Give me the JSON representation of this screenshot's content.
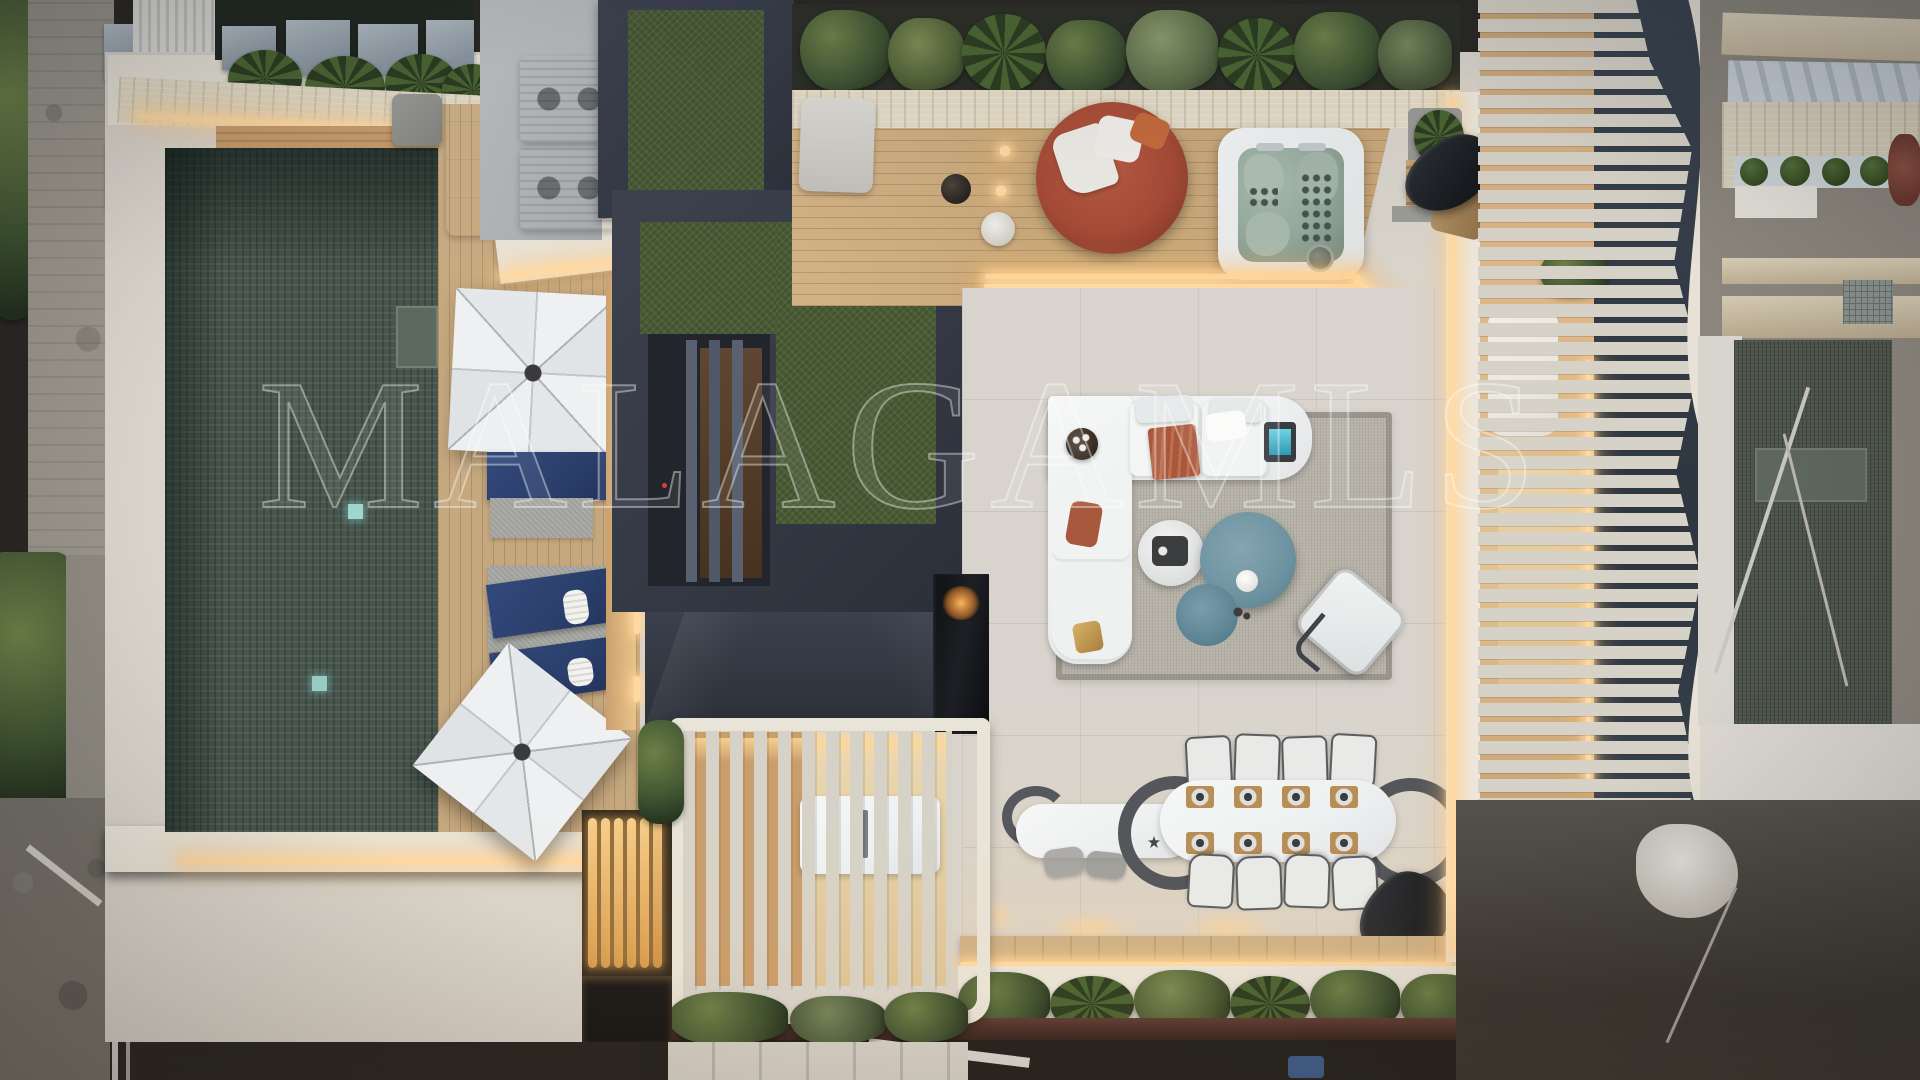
{
  "watermark": {
    "text": "MALAGAMLS"
  },
  "palette": {
    "street": "#292724",
    "pool": "#47554d",
    "lawn": "#4a5c35",
    "tile": "#d8d4cd",
    "rug": "#b6b2a8",
    "deck": "#c6a87e",
    "deck2": "#c9a87a",
    "charcoal": "#343945",
    "stone": "#e4dbc6",
    "cream": "#e9e4d8",
    "white": "#eef0f1",
    "navy": "#2b3f6b",
    "glow": "#ffd9a2",
    "terracotta": "#a8593d",
    "reddaybed": "#a64b36",
    "spa": "#93a89a",
    "teal": "#6e93a0",
    "slat": "#d7d2c7",
    "plant": "#3d5130",
    "planthi": "#6d8047",
    "flame": "#ffb45e"
  },
  "scene": {
    "description": "Aerial top-down drone photo at dusk of a modern luxury penthouse rooftop terrace with swimming pool, wood sun deck, parasols, artificial lawn, hot tub, lounge and dining areas, slatted pergolas with warm LED lighting, flanked by neighbouring buildings under construction",
    "areas": [
      "swimming-pool",
      "sun-deck",
      "parasols",
      "navy-sun-loungers",
      "artificial-lawn",
      "skylight-stairwell",
      "hvac-units",
      "red-round-daybed",
      "hot-tub",
      "outdoor-lounge-sofa",
      "outdoor-dining-table",
      "bar-counter",
      "fireplace",
      "slatted-pergola",
      "lamella-screen",
      "planters",
      "led-strip-lighting",
      "neighbour-construction",
      "neighbour-pool"
    ]
  }
}
